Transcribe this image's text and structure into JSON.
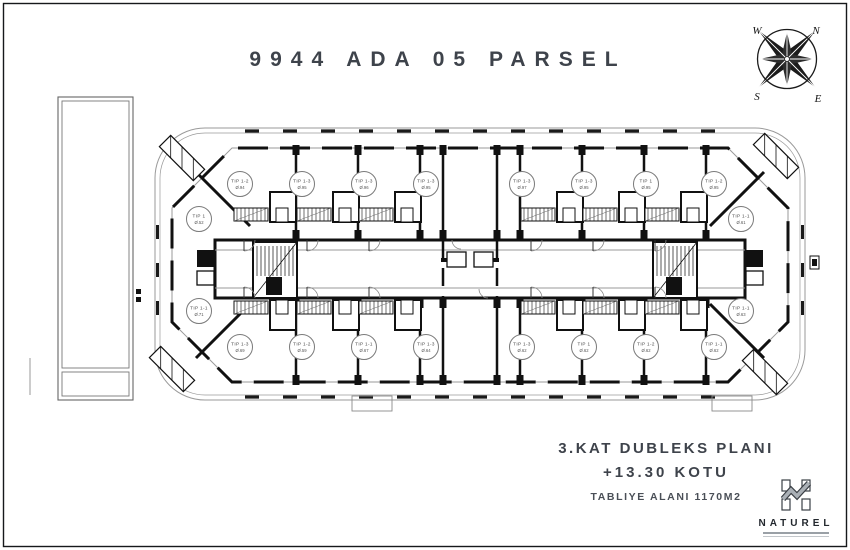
{
  "page": {
    "title": "9944 ADA 05 PARSEL"
  },
  "compass": {
    "north": "N",
    "east": "E",
    "south": "S",
    "west": "W"
  },
  "captions": {
    "plan": "3.KAT DUBLEKS PLANI",
    "elevation": "+13.30 KOTU",
    "slab_area": "TABLIYE ALANI 1170M2"
  },
  "logo": {
    "name": "NATUREL"
  },
  "plan": {
    "units": [
      {
        "label": "TIP 1-2",
        "area": "Ø.94"
      },
      {
        "label": "TIP 1-3",
        "area": "Ø.95"
      },
      {
        "label": "TIP 1-3",
        "area": "Ø.96"
      },
      {
        "label": "TIP 1-3",
        "area": "Ø.95"
      },
      {
        "label": "TIP 1-3",
        "area": "Ø.97"
      },
      {
        "label": "TIP 1-3",
        "area": "Ø.95"
      },
      {
        "label": "TIP 1",
        "area": "Ø.95"
      },
      {
        "label": "TIP 1-2",
        "area": "Ø.95"
      },
      {
        "label": "TIP 1-3",
        "area": "Ø.69"
      },
      {
        "label": "TIP 1-2",
        "area": "Ø.59"
      },
      {
        "label": "TIP 1-1",
        "area": "Ø.67"
      },
      {
        "label": "TIP 1-3",
        "area": "Ø.64"
      },
      {
        "label": "TIP 1-3",
        "area": "Ø.62"
      },
      {
        "label": "TIP 1",
        "area": "Ø.62"
      },
      {
        "label": "TIP 1-2",
        "area": "Ø.62"
      },
      {
        "label": "TIP 1-1",
        "area": "Ø.62"
      },
      {
        "label": "TIP 1",
        "area": "Ø.52"
      },
      {
        "label": "TIP 1-1",
        "area": "Ø.61"
      },
      {
        "label": "TIP 1-1",
        "area": "Ø.71"
      },
      {
        "label": "TIP 1-1",
        "area": "Ø.63"
      }
    ]
  }
}
